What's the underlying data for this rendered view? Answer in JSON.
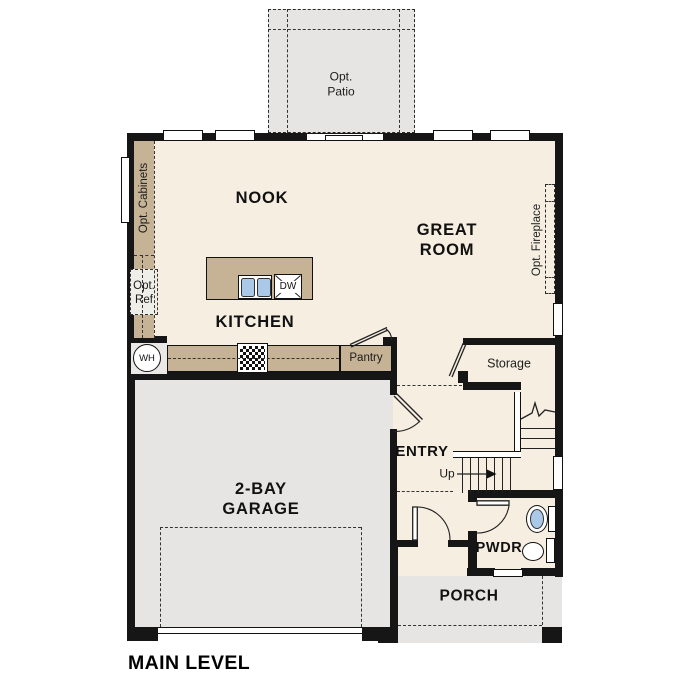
{
  "title": {
    "main_level": "MAIN LEVEL"
  },
  "rooms": {
    "nook": "NOOK",
    "great_room": "GREAT\nROOM",
    "kitchen": "KITCHEN",
    "garage": "2-BAY\nGARAGE",
    "entry": "ENTRY",
    "storage": "Storage",
    "pantry": "Pantry",
    "pwdr": "PWDR",
    "porch": "PORCH"
  },
  "annotations": {
    "opt_patio": "Opt.\nPatio",
    "opt_cabinets": "Opt. Cabinets",
    "opt_ref": "Opt.\nRef",
    "opt_fireplace": "Opt. Fireplace",
    "up": "Up",
    "wh": "WH",
    "dw": "DW"
  },
  "colors": {
    "floor": "#f5eee1",
    "cabinet": "#c6b295",
    "exterior_concrete": "#e6e5e3",
    "wall": "#161616",
    "fixture_blue": "#aac9e9"
  }
}
